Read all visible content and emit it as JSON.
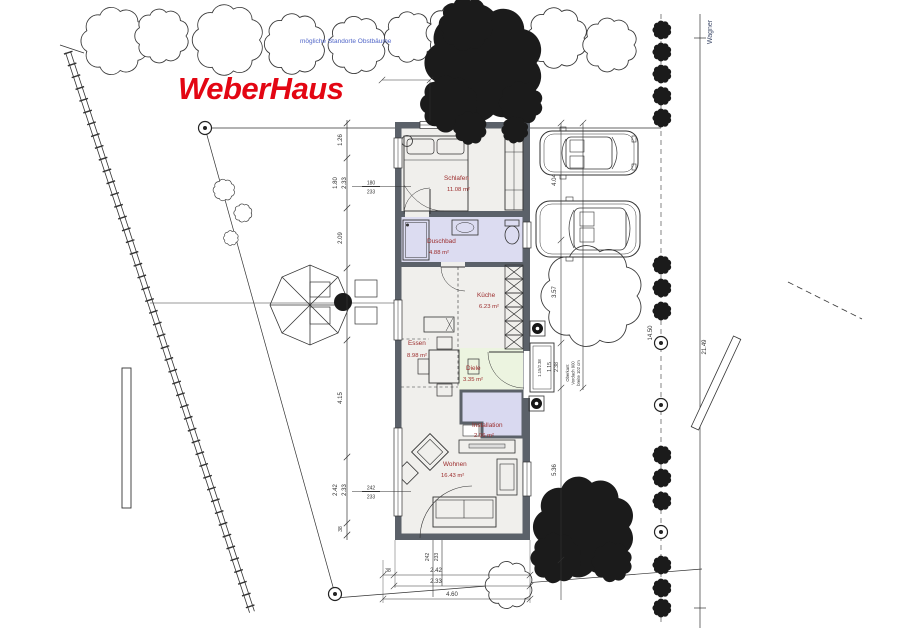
{
  "logo": "WeberHaus",
  "colors": {
    "logo": "#e30613",
    "room_label": "#9b2c2c",
    "wall": "#5b6169",
    "bath_floor": "#dcdcf1",
    "hall_floor": "#ecf4e0"
  },
  "notes": {
    "blue_note": "mögliche Standorte Obstbäume",
    "street": "Wagner",
    "door_size": "1.15/2.38",
    "canopy": [
      "Oberkant",
      "Vordach 900",
      "breite 102 cm"
    ]
  },
  "rooms": [
    {
      "name": "Schlafen",
      "area": "11.08 m²"
    },
    {
      "name": "Duschbad",
      "area": "4.88 m²"
    },
    {
      "name": "Küche",
      "area": "6.23 m²"
    },
    {
      "name": "Essen",
      "area": "8.98 m²"
    },
    {
      "name": "Diele",
      "area": "3.35 m²"
    },
    {
      "name": "Installation",
      "area": "2.06 m²"
    },
    {
      "name": "Wohnen",
      "area": "16.43 m²"
    }
  ],
  "dims": {
    "left": [
      "1.26",
      "1.80",
      "2.33",
      "2.09",
      "4.15",
      "2.42",
      "2.33",
      "38"
    ],
    "frac_top": {
      "a": "180",
      "b": "233"
    },
    "frac_bottom": {
      "a": "242",
      "b": "233"
    },
    "right": [
      "4.04",
      "3.57",
      "1.15",
      "2.38",
      "5.36"
    ],
    "bottom": {
      "offset": "38",
      "a": "2.42",
      "b": "2.33",
      "total": "4.60",
      "va": "242",
      "vb": "233"
    },
    "site_right": {
      "inner": "14.50",
      "outer": "21.49"
    }
  }
}
